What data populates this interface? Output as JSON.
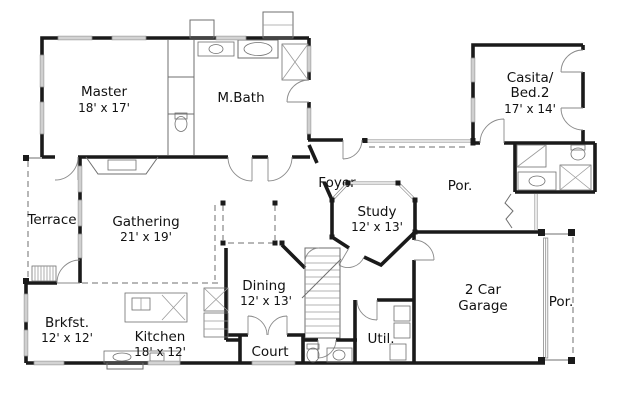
{
  "colors": {
    "wall": "#1a1a1a",
    "thin": "#6f6f6f",
    "light": "#9b9b9b",
    "bg": "#ffffff"
  },
  "rooms": {
    "master": {
      "name": "Master",
      "dims": "18' x 17'"
    },
    "mbath": {
      "name": "M.Bath"
    },
    "casita": {
      "line1": "Casita/",
      "line2": "Bed.2",
      "dims": "17' x 14'"
    },
    "foyer": {
      "name": "Foyer"
    },
    "study": {
      "name": "Study",
      "dims": "12' x 13'"
    },
    "porch_center": {
      "name": "Por."
    },
    "porch_right": {
      "name": "Por."
    },
    "terrace": {
      "name": "Terrace"
    },
    "gathering": {
      "name": "Gathering",
      "dims": "21' x 19'"
    },
    "breakfast": {
      "name": "Brkfst.",
      "dims": "12' x 12'"
    },
    "kitchen": {
      "name": "Kitchen",
      "dims": "18' x 12'"
    },
    "dining": {
      "name": "Dining",
      "dims": "12' x 13'"
    },
    "court": {
      "name": "Court"
    },
    "utility": {
      "name": "Util."
    },
    "garage": {
      "line1": "2 Car",
      "line2": "Garage"
    }
  }
}
